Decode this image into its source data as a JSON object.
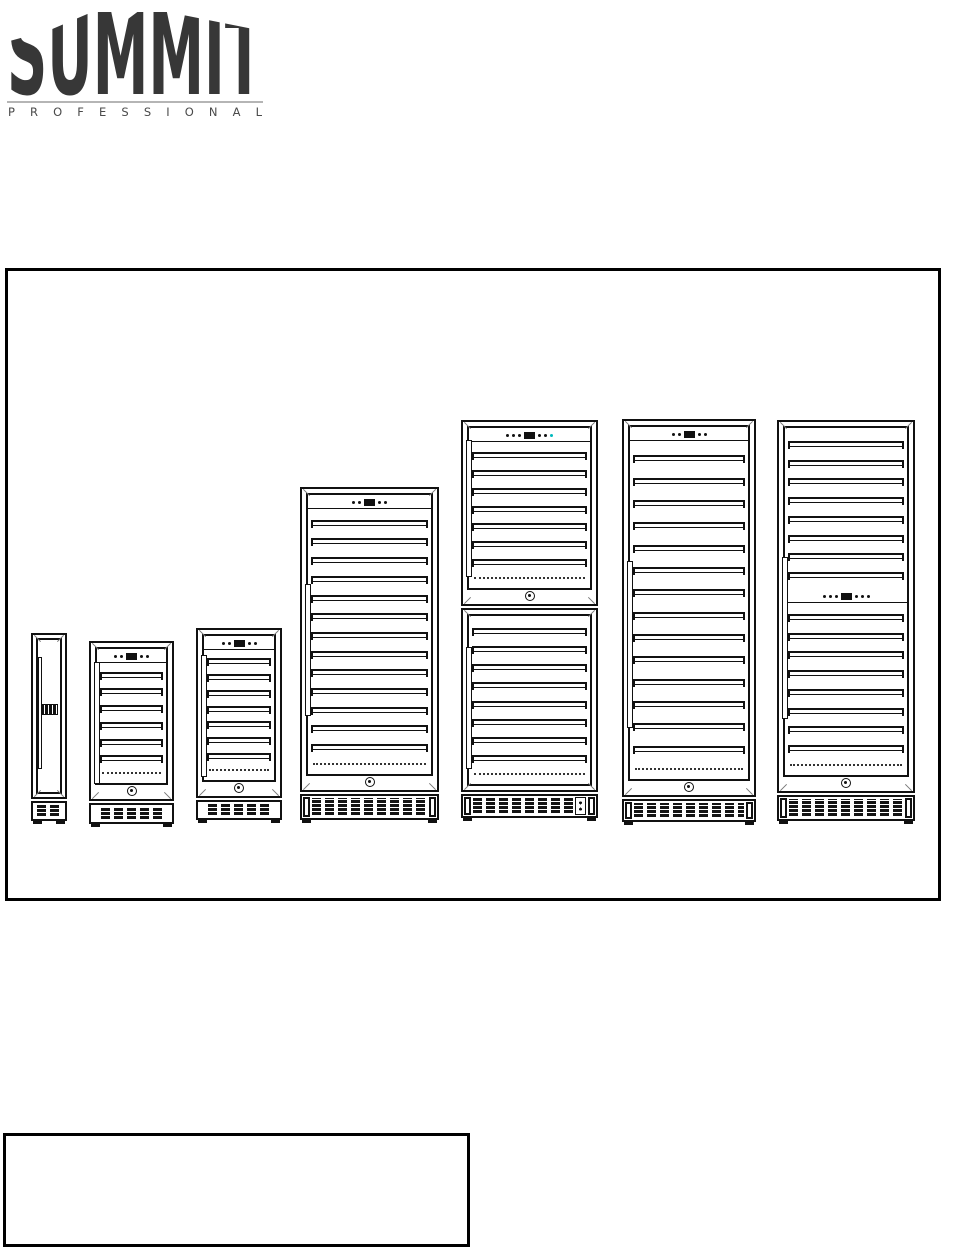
{
  "page": {
    "background": "#ffffff"
  },
  "logo": {
    "title": "SUMMIT",
    "subtitle": "P R O F E S S I O N A L",
    "title_color": "#373737",
    "subtitle_color": "#4a4a4a",
    "rule_color": "#b5b5b5"
  },
  "diagram": {
    "description": "line drawings of seven wine storage units in ascending size",
    "border_color": "#000000",
    "line_color": "#141414",
    "accent_color": "#00b9bd",
    "units": [
      {
        "name": "slim-column-wine-cooler",
        "slim": true,
        "x": 23,
        "y": 362,
        "w": 36,
        "doors": [
          {
            "h": 166,
            "rows": [
              {
                "t": "display"
              }
            ],
            "handle": {
              "top": 22,
              "h": 110
            },
            "lock": false
          }
        ],
        "base": {
          "h": 20
        },
        "feet": 2
      },
      {
        "name": "compact-wine-cooler",
        "x": 81,
        "y": 370,
        "w": 85,
        "doors": [
          {
            "h": 160,
            "rows": [
              {
                "t": "control",
                "p": "ddDdd"
              },
              {
                "t": "shelves",
                "n": 6
              }
            ],
            "handle": {
              "top": 19,
              "h": 120
            },
            "lock": true
          }
        ],
        "base": {
          "h": 21
        },
        "feet": 2
      },
      {
        "name": "undercounter-wine-cellar",
        "x": 188,
        "y": 357,
        "w": 86,
        "doors": [
          {
            "h": 170,
            "rows": [
              {
                "t": "control",
                "p": "ddDdd"
              },
              {
                "t": "shelves",
                "n": 7
              }
            ],
            "handle": {
              "top": 25,
              "h": 120
            },
            "lock": true
          }
        ],
        "base": {
          "h": 20
        },
        "feet": 2
      },
      {
        "name": "midsize-wine-cellar",
        "x": 292,
        "y": 216,
        "w": 139,
        "doors": [
          {
            "h": 305,
            "rows": [
              {
                "t": "control",
                "p": "ddDdd"
              },
              {
                "t": "shelves",
                "n": 13
              }
            ],
            "handle": {
              "top": 95,
              "h": 130
            },
            "lock": true
          }
        ],
        "base": {
          "h": 26,
          "brackets": true
        },
        "feet": 2
      },
      {
        "name": "dual-zone-wine-cellar",
        "x": 453,
        "y": 149,
        "w": 137,
        "doors": [
          {
            "h": 186,
            "rows": [
              {
                "t": "control",
                "p": "dddDdda"
              },
              {
                "t": "shelves",
                "n": 7
              }
            ],
            "handle": {
              "top": 18,
              "h": 135
            },
            "lock": true
          },
          {
            "h": 184,
            "rows": [
              {
                "t": "shelves",
                "n": 8
              }
            ],
            "handle": {
              "top": 37,
              "h": 120
            },
            "lock": false
          }
        ],
        "base": {
          "h": 24,
          "brackets": true,
          "sidebox": true
        },
        "feet": 2
      },
      {
        "name": "fullsize-wine-cellar",
        "x": 614,
        "y": 148,
        "w": 134,
        "doors": [
          {
            "h": 378,
            "rows": [
              {
                "t": "control",
                "p": "ddDdd"
              },
              {
                "t": "shelves",
                "n": 14
              }
            ],
            "handle": {
              "top": 140,
              "h": 165
            },
            "lock": true
          }
        ],
        "base": {
          "h": 23,
          "brackets": true
        },
        "feet": 2
      },
      {
        "name": "fullsize-dual-section-wine-cellar",
        "x": 769,
        "y": 149,
        "w": 138,
        "doors": [
          {
            "h": 373,
            "rows": [
              {
                "t": "shelves",
                "n": 8
              },
              {
                "t": "control",
                "p": "dddDddd"
              },
              {
                "t": "shelves",
                "n": 8
              }
            ],
            "handle": {
              "top": 135,
              "h": 160
            },
            "lock": true
          }
        ],
        "base": {
          "h": 26,
          "brackets": true
        },
        "feet": 2
      }
    ]
  },
  "notes_box": {
    "text": ""
  }
}
